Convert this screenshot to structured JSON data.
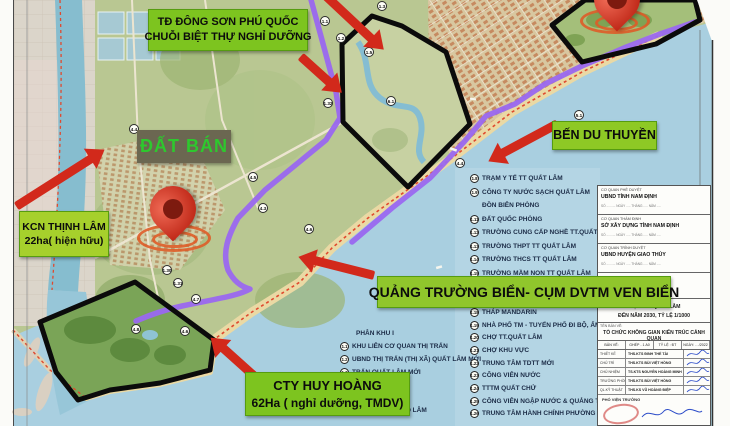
{
  "banners": {
    "dong_son": {
      "line1": "TĐ ĐÔNG SƠN PHÚ QUỐC",
      "line2": "CHUỖI BIỆT THỰ NGHỈ DƯỠNG"
    },
    "dat_ban": "ĐẤT BÁN",
    "kcn": {
      "line1": "KCN THỊNH LÂM",
      "line2": "22ha( hiện hữu)"
    },
    "ben_du_thuyen": "BẾN DU THUYỀN",
    "quang_truong": "QUẢNG TRƯỜNG BIỂN- CỤM DVTM VEN BIỂN",
    "huy_hoang": {
      "line1": "CTY HUY HOÀNG",
      "line2": "62Ha ( nghỉ dưỡng, TMDV)"
    }
  },
  "legend": {
    "left": {
      "header": "PHÂN KHU I",
      "items": [
        {
          "num": "1.1",
          "label": "KHU LIÊN CƠ QUAN THỊ TRẤN"
        },
        {
          "num": "1.2",
          "label": "UBND THỊ TRẤN (THỊ XÃ) QUẤT LÂM MỚI"
        },
        {
          "num": "1.3",
          "label": "TRẤN QUẤT LÂM MỚI"
        },
        {
          "num": "1.4",
          "label": "ÂM"
        },
        {
          "num": "1.7",
          "label": "HỢP TÁC XÃ GIAO LÂM"
        }
      ]
    },
    "right": {
      "items1": [
        {
          "num": "1.8",
          "label": "TRẠM Y TẾ TT QUẤT LÂM"
        },
        {
          "num": "1.9",
          "label": "CÔNG TY NƯỚC SẠCH QUẤT LÂM"
        },
        {
          "num": "",
          "label": "ĐỒN BIÊN PHÒNG"
        },
        {
          "num": "1.11",
          "label": "ĐẤT QUỐC PHÒNG"
        },
        {
          "num": "1.12",
          "label": "TRƯỜNG CUNG CẤP NGHỀ TT.QUẤT"
        },
        {
          "num": "1.13",
          "label": "TRƯỜNG THPT TT QUẤT LÂM"
        },
        {
          "num": "1.14",
          "label": "TRƯỜNG THCS TT QUẤT LÂM"
        },
        {
          "num": "1.15",
          "label": "TRƯỜNG MẦM NON TT QUẤT LÂM"
        }
      ],
      "items2": [
        {
          "num": "1.18",
          "label": "THÁP MANDARIN"
        },
        {
          "num": "1.19",
          "label": "NHÀ PHỐ TM - TUYẾN PHỐ ĐI BỘ, ẨM"
        },
        {
          "num": "1.20",
          "label": "CHỢ TT.QUẤT LÂM"
        },
        {
          "num": "1.21",
          "label": "CHỢ KHU VỰC"
        },
        {
          "num": "1.22",
          "label": "TRUNG TÂM TDTT MỚI"
        },
        {
          "num": "1.23",
          "label": "CÔNG VIÊN NƯỚC"
        },
        {
          "num": "1.24",
          "label": "TTTM QUẤT CHỬ"
        },
        {
          "num": "1.25",
          "label": "CÔNG VIÊN NGẬP NƯỚC & QUẢNG T"
        },
        {
          "num": "1.26",
          "label": "TRUNG TÂM HÀNH CHÍNH PHƯỜNG"
        }
      ]
    }
  },
  "title_block": {
    "approvals": [
      {
        "role": "CƠ QUAN PHÊ DUYỆT",
        "name": "UBND TỈNH NAM ĐỊNH",
        "note": "SỐ .......... NGÀY ..... THÁNG ..... NĂM ....."
      },
      {
        "role": "CƠ QUAN THẨM ĐỊNH",
        "name": "SỞ XÂY DỰNG TỈNH NAM ĐỊNH",
        "note": "SỐ .......... NGÀY ..... THÁNG ..... NĂM ....."
      },
      {
        "role": "CƠ QUAN TRÌNH DUYỆT",
        "name": "UBND HUYỆN GIAO THỦY",
        "note": "SỐ .......... NGÀY ..... THÁNG ..... NĂM ....."
      }
    ],
    "project": {
      "line1": "THỊ TRẤN QUẤT LÂM",
      "line2": "ĐẾN NĂM 2030, TỶ LỆ 1/1000"
    },
    "drawing": {
      "label": "TÊN BẢN VẼ:",
      "value": "TỔ CHỨC KHÔNG GIAN KIẾN TRÚC CẢNH QUAN"
    },
    "sheet_header": [
      "BẢN VẼ:",
      "GHÉP - 1 A0",
      "TỶ LỆ : ĐT",
      "NGÀY: …/2022"
    ],
    "staff": [
      {
        "role": "THIẾT KẾ",
        "name": "THS.KTS ĐINH THẾ TÀI"
      },
      {
        "role": "CHỦ TRÌ",
        "name": "THS.KTS BÙI VIỆT HỒNG"
      },
      {
        "role": "CHỦ NHIỆM",
        "name": "TS.KTS NGUYỄN HOÀNG MINH"
      },
      {
        "role": "TRƯỞNG PHÒNG",
        "name": "THS.KTS BÙI VIỆT HỒNG"
      },
      {
        "role": "QL.KỸ THUẬT",
        "name": "THS.KS VŨ HOÀNG ĐIỆP"
      }
    ],
    "footer_role": "PHÓ VIỆN TRƯỞNG"
  },
  "map": {
    "markers": [
      {
        "label": "1.1"
      },
      {
        "label": "1.2"
      },
      {
        "label": "1.3"
      },
      {
        "label": "1.5"
      },
      {
        "label": "1.32"
      },
      {
        "label": "6.1"
      },
      {
        "label": "4.5"
      },
      {
        "label": "4.3"
      },
      {
        "label": "4.6"
      },
      {
        "label": "4.4"
      },
      {
        "label": "4.4"
      },
      {
        "label": "5.1"
      },
      {
        "label": "1.30"
      },
      {
        "label": "1.31"
      },
      {
        "label": "4.7"
      },
      {
        "label": "4.8"
      },
      {
        "label": "4.6"
      }
    ]
  },
  "colors": {
    "banner_green": "#7dc41f",
    "accent_red": "#d2291b",
    "route_purple": "#9a68f0",
    "sea_blue": "#a9cfe0",
    "boundary_black": "#0b0b0b"
  }
}
